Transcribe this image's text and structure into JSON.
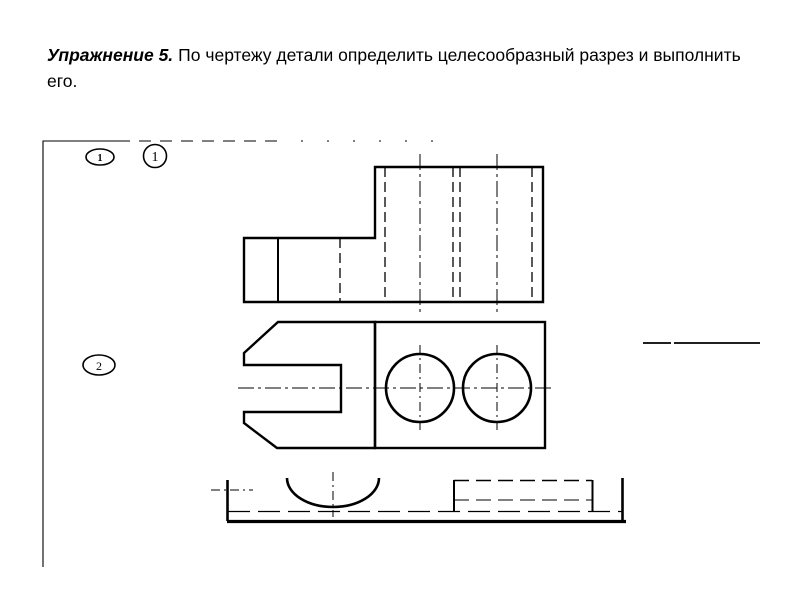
{
  "colors": {
    "background": "#ffffff",
    "ink": "#000000"
  },
  "title": {
    "lead": "Упражнение 5.",
    "body": "По чертежу детали определить целесообразный разрез и выполнить его."
  },
  "markers": {
    "oval_top": "1",
    "circle_top": "1",
    "oval_left": "2"
  }
}
